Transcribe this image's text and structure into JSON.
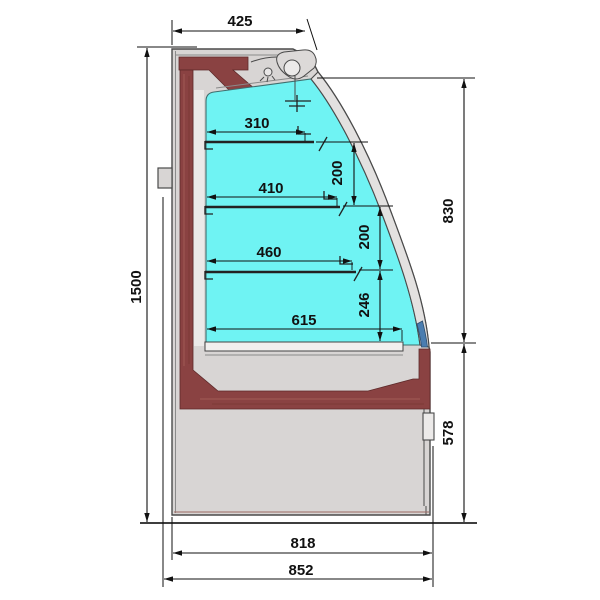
{
  "drawing": {
    "subject": "refrigerated-display-case-cross-section",
    "view": "side-section",
    "dims": {
      "top_depth": "425",
      "overall_height": "1500",
      "shelf1_depth": "310",
      "shelf2_depth": "410",
      "shelf3_depth": "460",
      "bottom_shelf_depth": "615",
      "gap_shelf1_shelf2": "200",
      "gap_shelf2_shelf3": "246",
      "gap_top_200_upper": "200",
      "glass_height": "830",
      "base_height": "578",
      "base_depth": "818",
      "overall_depth": "852"
    },
    "colors": {
      "interior_cyan": "#6ff3f3",
      "insulation_maroon": "#8a4242",
      "body_gray": "#d8d5d4",
      "glass_band": "#e3e1e0",
      "glass_edge_blue": "#4a7db0",
      "line_black": "#111111"
    }
  }
}
